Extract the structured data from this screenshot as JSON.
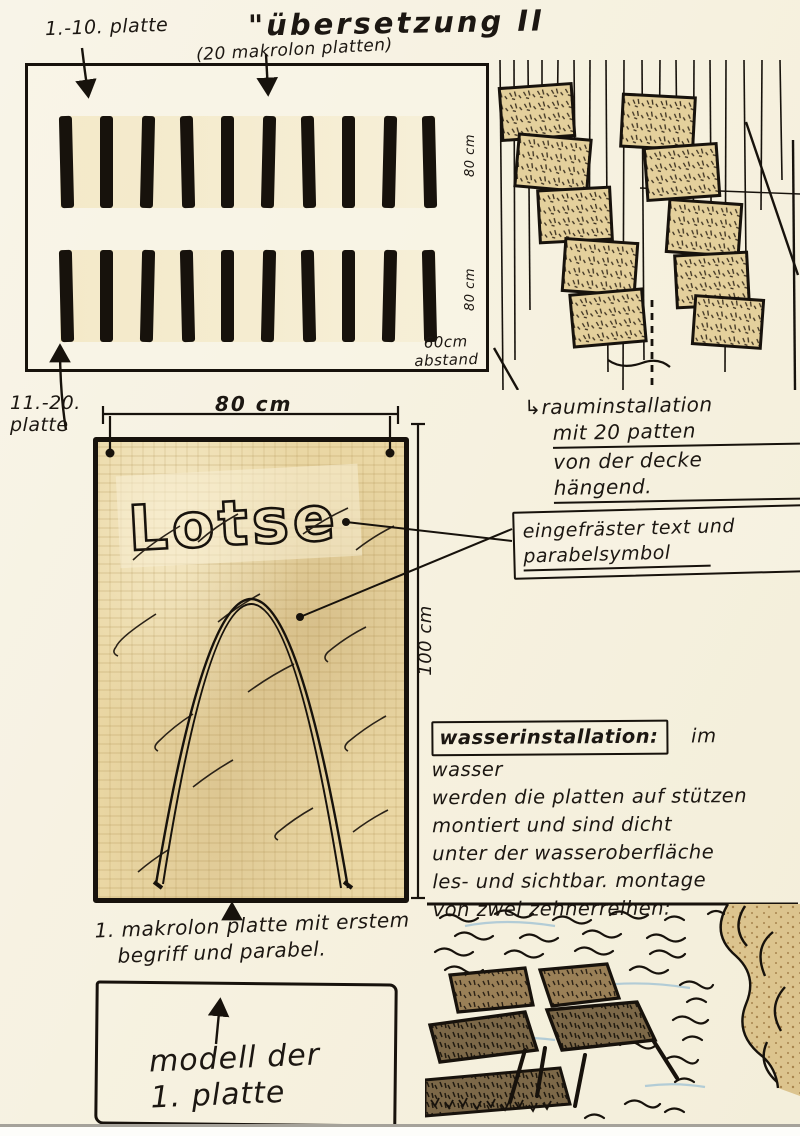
{
  "colors": {
    "paper": "#f7f2e2",
    "ink": "#17120c",
    "panel_tan": "#ead7a4",
    "plate_brown": "#967c52",
    "plate_dark": "#6e5a3e",
    "pencil_blue": "#9cc0d4"
  },
  "icons": {
    "corner_arrow": "↳"
  },
  "title": "\"übersetzung II",
  "subtitle": "(20 makrolon platten)",
  "plate_grid": {
    "label_top": "1.-10. platte",
    "label_bottom_l1": "11.-20.",
    "label_bottom_l2": "platte",
    "row1_dim": "80 cm",
    "row2_dim": "80 cm",
    "gap_dim_l1": "60cm",
    "gap_dim_l2": "abstand",
    "bars_per_row": 10
  },
  "model": {
    "width_dim": "80 cm",
    "height_dim": "100 cm",
    "word": "Lotse",
    "caption_l1": "1. makrolon platte mit erstem",
    "caption_l2": "begriff und parabel.",
    "box_l1": "modell der",
    "box_l2": "1. platte"
  },
  "notes": {
    "raum": {
      "l1": "rauminstallation",
      "l2": "mit 20 patten",
      "l3": "von der decke hängend."
    },
    "engrave": {
      "l1": "eingefräster text und",
      "l2": "parabelsymbol"
    },
    "wasser_header": "wasserinstallation:",
    "wasser": {
      "l1": "im wasser",
      "l2": "werden die platten auf stützen",
      "l3": "montiert und sind dicht",
      "l4": "unter der wasseroberfläche",
      "l5": "les- und sichtbar. montage",
      "l6": "von zwei zehnerreihen:"
    }
  }
}
